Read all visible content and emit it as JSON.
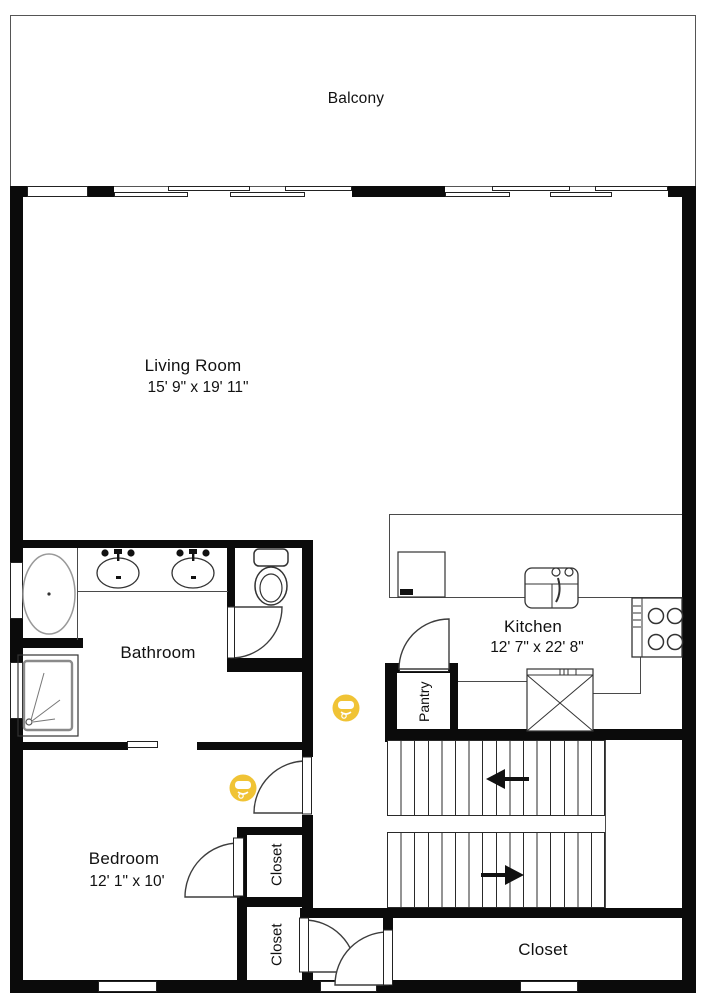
{
  "plan_title": "Apartment floor plan",
  "rooms": {
    "balcony": {
      "label": "Balcony"
    },
    "living_room": {
      "label": "Living Room",
      "dims": "15' 9\" x 19' 11\""
    },
    "bathroom": {
      "label": "Bathroom"
    },
    "kitchen": {
      "label": "Kitchen",
      "dims": "12' 7\" x 22' 8\""
    },
    "pantry": {
      "label": "Pantry"
    },
    "bedroom": {
      "label": "Bedroom",
      "dims": "12' 1\" x 10'"
    },
    "bedroom_closet_upper": {
      "label": "Closet"
    },
    "bedroom_closet_lower": {
      "label": "Closet"
    },
    "hall_closet": {
      "label": "Closet"
    }
  },
  "fixtures": [
    "bathtub",
    "shower",
    "double-vanity-sinks",
    "toilet",
    "dishwasher",
    "kitchen-sink",
    "stove",
    "refrigerator",
    "stairs"
  ],
  "stairs": {
    "upper_flight_arrow": "left",
    "lower_flight_arrow": "right"
  },
  "icons": {
    "smoke_detector_count": 2
  },
  "colors": {
    "walls": "#0b0b0b",
    "fixture_lines": "#4a4a4a",
    "smoke_detector": "#F0C335",
    "background": "#ffffff"
  }
}
